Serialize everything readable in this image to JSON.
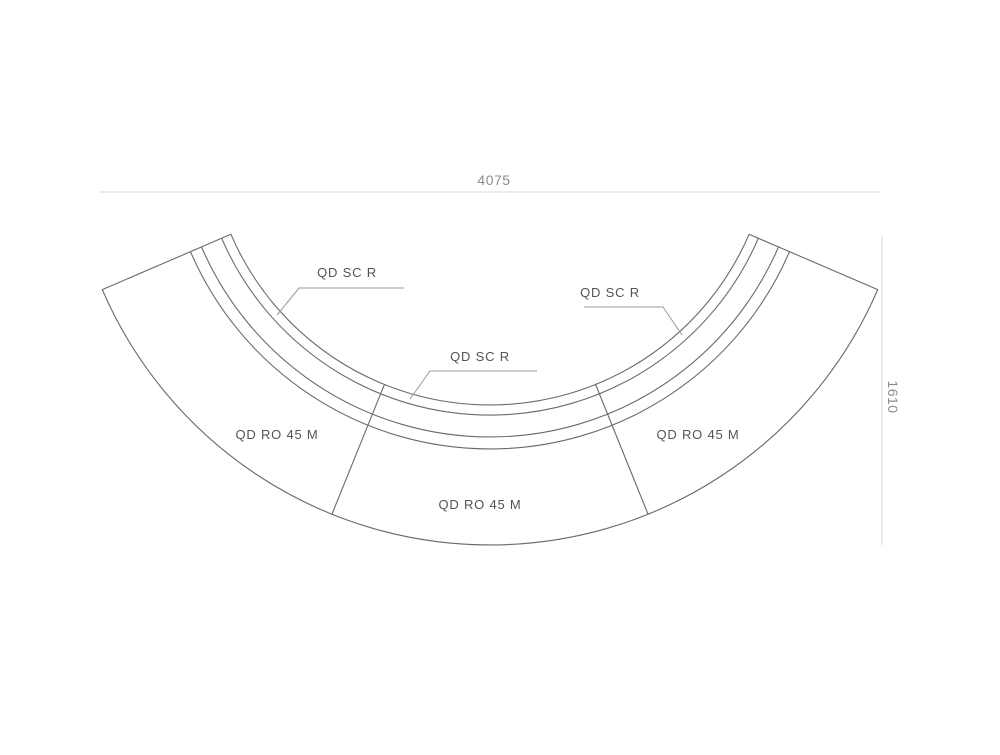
{
  "drawing": {
    "description": "Curved reception desk plan view composed of three curved modules with three curved screens",
    "dimensions": {
      "width_label": "4075",
      "height_label": "1610"
    },
    "screen_labels": [
      {
        "text": "QD SC R"
      },
      {
        "text": "QD SC R"
      },
      {
        "text": "QD SC R"
      }
    ],
    "module_labels": [
      {
        "text": "QD RO 45 M"
      },
      {
        "text": "QD RO 45 M"
      },
      {
        "text": "QD RO 45 M"
      }
    ],
    "colors": {
      "background": "#ffffff",
      "line": "#6a6a6a",
      "leader_line": "#9a9a9a",
      "dimension_line": "#d8d8d8",
      "label_text": "#545454",
      "dimension_text": "#8d8d8d"
    }
  }
}
